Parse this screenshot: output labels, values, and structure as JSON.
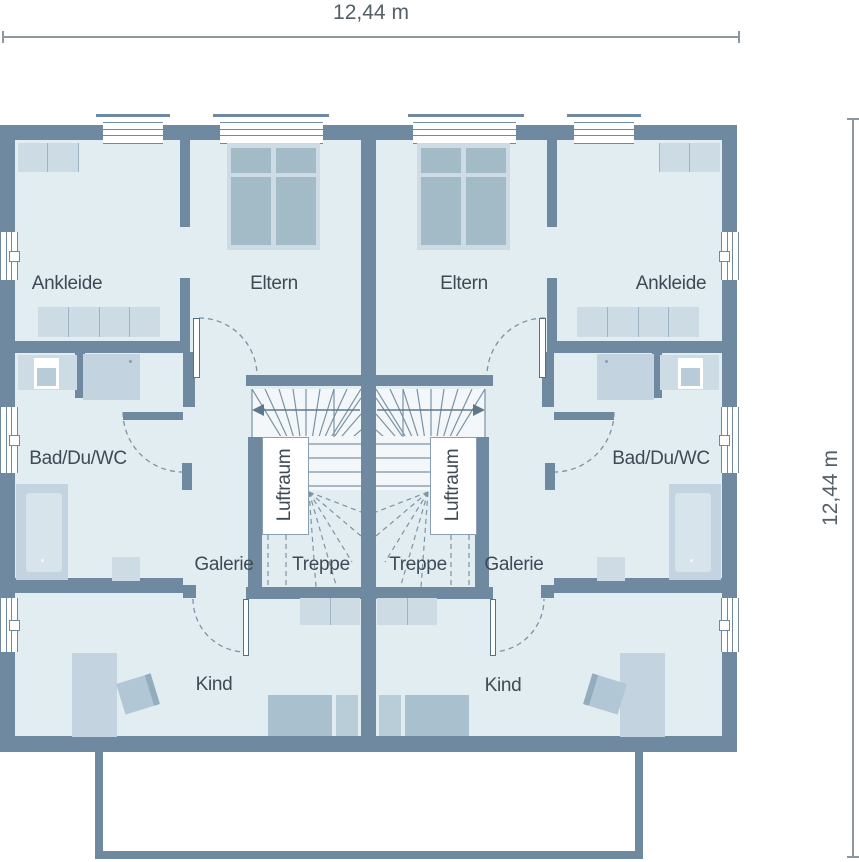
{
  "drawing": {
    "type": "floor-plan",
    "description": "Mirrored duplex upper-floor plan (Dachgeschoss) of a semi-detached house"
  },
  "dimensions": {
    "top": "12,44 m",
    "right": "12,44 m"
  },
  "rooms": {
    "left": {
      "ankleide": "Ankleide",
      "eltern": "Eltern",
      "bad": "Bad/Du/WC",
      "galerie": "Galerie",
      "treppe": "Treppe",
      "kind": "Kind",
      "luftraum": "Luftraum"
    },
    "right": {
      "ankleide": "Ankleide",
      "eltern": "Eltern",
      "bad": "Bad/Du/WC",
      "galerie": "Galerie",
      "treppe": "Treppe",
      "kind": "Kind",
      "luftraum": "Luftraum"
    }
  },
  "colors": {
    "wall": "#6f8aa0",
    "room_fill": "#e2edf1",
    "stair_fill": "#f3f7f9",
    "furniture_light": "#ccdbe4",
    "furniture_medium": "#a9c0cf",
    "bed_pane": "#a3bac7",
    "stair_line": "#7b93a4",
    "text": "#3e4a54",
    "dimension": "#8d979e"
  }
}
